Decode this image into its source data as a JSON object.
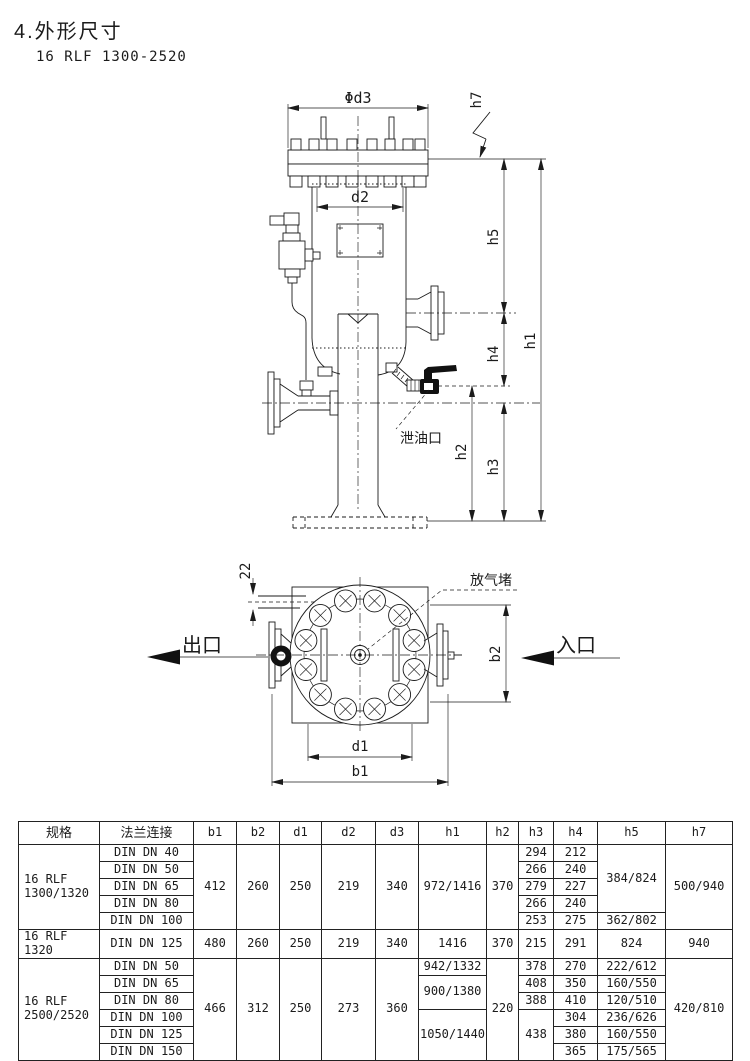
{
  "page": {
    "title": "4.外形尺寸",
    "model": "16 RLF 1300-2520"
  },
  "side": {
    "d3": "Φd3",
    "d2": "d2",
    "h7": "h7",
    "h5": "h5",
    "h4": "h4",
    "h3": "h3",
    "h2": "h2",
    "h1": "h1",
    "drain": "泄油口"
  },
  "top": {
    "offset": "22",
    "b2": "b2",
    "d1": "d1",
    "b1": "b1",
    "vent": "放气堵",
    "outlet": "出口",
    "inlet": "入口"
  },
  "table": {
    "headers": [
      "规格",
      "法兰连接",
      "b1",
      "b2",
      "d1",
      "d2",
      "d3",
      "h1",
      "h2",
      "h3",
      "h4",
      "h5",
      "h7"
    ],
    "rows": [
      [
        {
          "t": "16 RLF\n1300/1320",
          "rs": 5,
          "al": "l"
        },
        {
          "t": "DIN DN 40"
        },
        {
          "t": "412",
          "rs": 5
        },
        {
          "t": "260",
          "rs": 5
        },
        {
          "t": "250",
          "rs": 5
        },
        {
          "t": "219",
          "rs": 5
        },
        {
          "t": "340",
          "rs": 5
        },
        {
          "t": "972/1416",
          "rs": 5
        },
        {
          "t": "370",
          "rs": 5
        },
        {
          "t": "294"
        },
        {
          "t": "212"
        },
        {
          "t": "384/824",
          "rs": 4
        },
        {
          "t": "500/940",
          "rs": 5
        }
      ],
      [
        {
          "t": "DIN DN 50"
        },
        {
          "t": "266"
        },
        {
          "t": "240"
        }
      ],
      [
        {
          "t": "DIN DN 65"
        },
        {
          "t": "279"
        },
        {
          "t": "227"
        }
      ],
      [
        {
          "t": "DIN DN 80"
        },
        {
          "t": "266"
        },
        {
          "t": "240"
        }
      ],
      [
        {
          "t": "DIN DN 100"
        },
        {
          "t": "253"
        },
        {
          "t": "275"
        },
        {
          "t": "362/802"
        }
      ],
      [
        {
          "t": "16 RLF 1320",
          "al": "l"
        },
        {
          "t": "DIN DN 125"
        },
        {
          "t": "480"
        },
        {
          "t": "260"
        },
        {
          "t": "250"
        },
        {
          "t": "219"
        },
        {
          "t": "340"
        },
        {
          "t": "1416"
        },
        {
          "t": "370"
        },
        {
          "t": "215"
        },
        {
          "t": "291"
        },
        {
          "t": "824"
        },
        {
          "t": "940"
        }
      ],
      [
        {
          "t": "16 RLF\n2500/2520",
          "rs": 6,
          "al": "l"
        },
        {
          "t": "DIN DN 50"
        },
        {
          "t": "466",
          "rs": 6
        },
        {
          "t": "312",
          "rs": 6
        },
        {
          "t": "250",
          "rs": 6
        },
        {
          "t": "273",
          "rs": 6
        },
        {
          "t": "360",
          "rs": 6
        },
        {
          "t": "942/1332"
        },
        {
          "t": "220",
          "rs": 6
        },
        {
          "t": "378"
        },
        {
          "t": "270"
        },
        {
          "t": "222/612"
        },
        {
          "t": "420/810",
          "rs": 6
        }
      ],
      [
        {
          "t": "DIN DN 65"
        },
        {
          "t": "900/1380",
          "rs": 2
        },
        {
          "t": "408"
        },
        {
          "t": "350"
        },
        {
          "t": "160/550"
        }
      ],
      [
        {
          "t": "DIN DN 80"
        },
        {
          "t": "388"
        },
        {
          "t": "410"
        },
        {
          "t": "120/510"
        }
      ],
      [
        {
          "t": "DIN DN 100"
        },
        {
          "t": "1050/1440",
          "rs": 3
        },
        {
          "t": "438",
          "rs": 3
        },
        {
          "t": "304"
        },
        {
          "t": "236/626"
        }
      ],
      [
        {
          "t": "DIN DN 125"
        },
        {
          "t": "380"
        },
        {
          "t": "160/550"
        }
      ],
      [
        {
          "t": "DIN DN 150"
        },
        {
          "t": "365"
        },
        {
          "t": "175/565"
        }
      ]
    ]
  }
}
